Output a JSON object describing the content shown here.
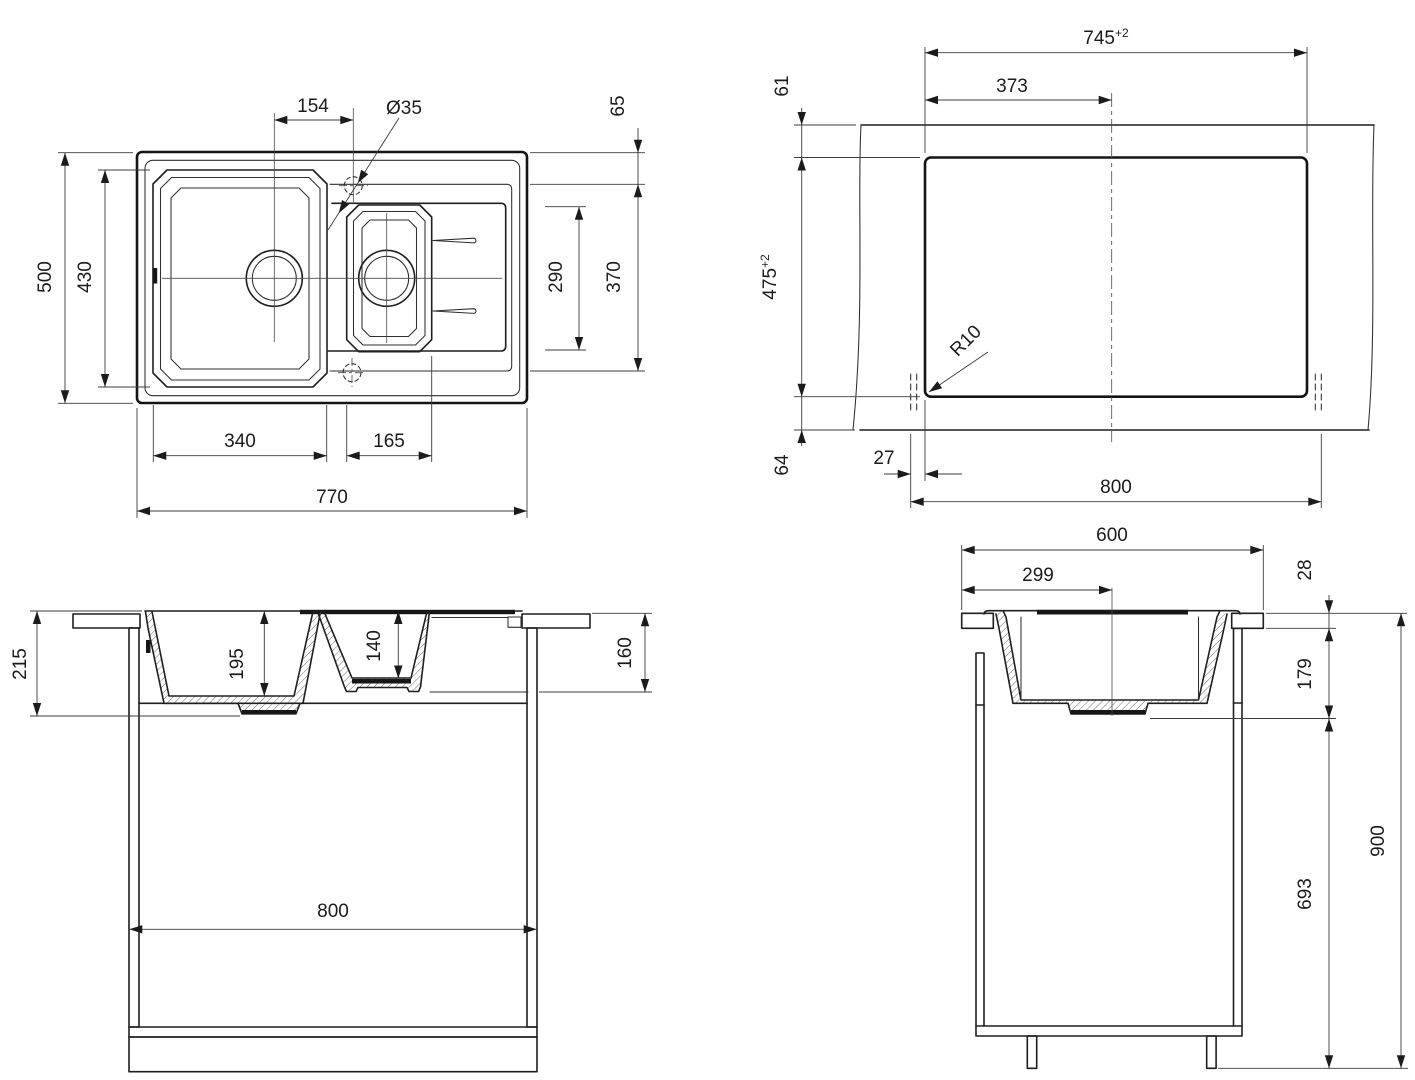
{
  "drawing": {
    "plan": {
      "d154": "154",
      "d35": "Ø35",
      "d65": "65",
      "d500": "500",
      "d430": "430",
      "d290": "290",
      "d370": "370",
      "d340": "340",
      "d165": "165",
      "d770": "770"
    },
    "cutout": {
      "d745": "745",
      "tol745": "+2",
      "d373": "373",
      "d61": "61",
      "d475": "475",
      "tol475": "+2",
      "d64": "64",
      "d27": "27",
      "d800": "800",
      "r10": "R10"
    },
    "front": {
      "d215": "215",
      "d195": "195",
      "d140": "140",
      "d160": "160",
      "d800": "800"
    },
    "side": {
      "d600": "600",
      "d299": "299",
      "d28": "28",
      "d179": "179",
      "d693": "693",
      "d900": "900"
    }
  }
}
